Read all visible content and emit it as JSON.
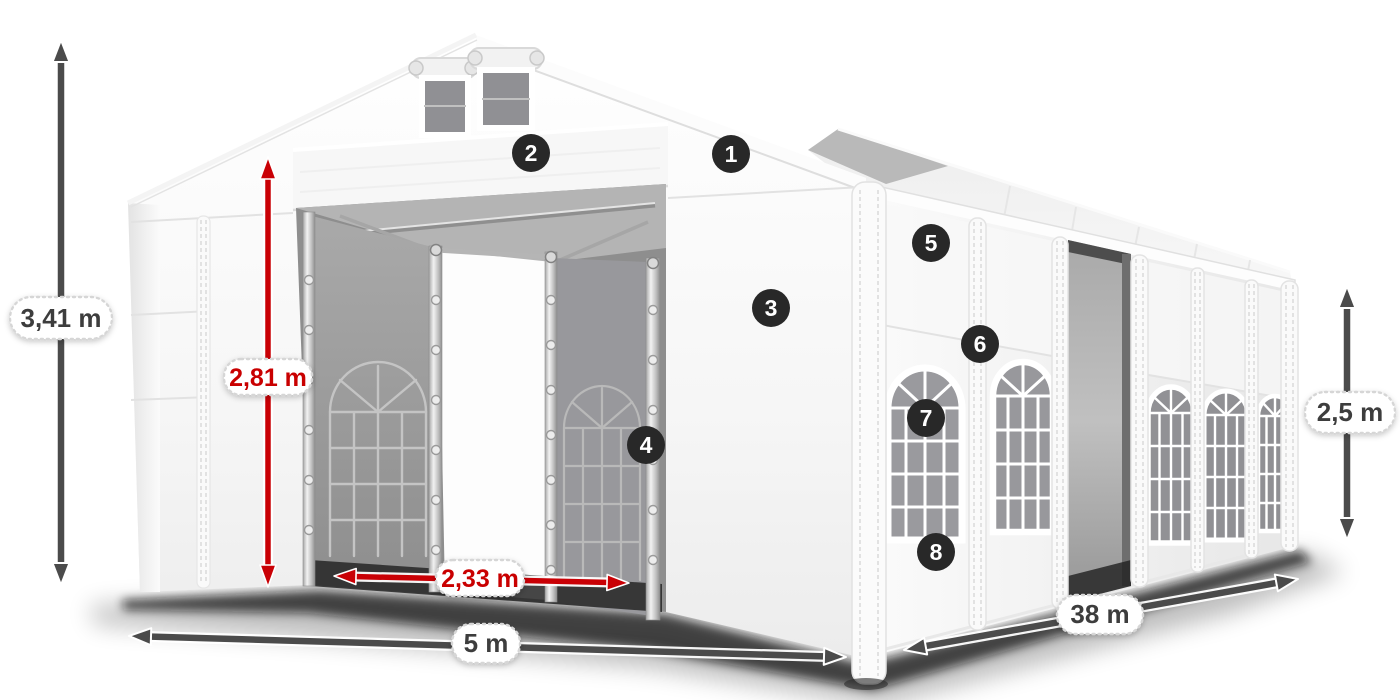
{
  "diagram": {
    "type": "tent-dimension-diagram",
    "subject": "white marquee tent with open front doors, numbered feature callouts and measurements",
    "dimensions": {
      "total_height": "3,41 m",
      "door_height": "2,81 m",
      "door_width": "2,33 m",
      "front_width": "5 m",
      "length": "38 m",
      "side_height": "2,5 m"
    },
    "callouts": [
      "1",
      "2",
      "3",
      "4",
      "5",
      "6",
      "7",
      "8"
    ],
    "colors": {
      "accent_red": "#C90005",
      "arrow_gray": "#4B4B4B",
      "badge_background": "#282828",
      "badge_number": "#FFFFFF",
      "pill_background": "#FFFFFF",
      "pill_text": "#3E3E3E",
      "tent_white": "#F6F6F6",
      "interior_gray": "#9A9A9A"
    }
  }
}
